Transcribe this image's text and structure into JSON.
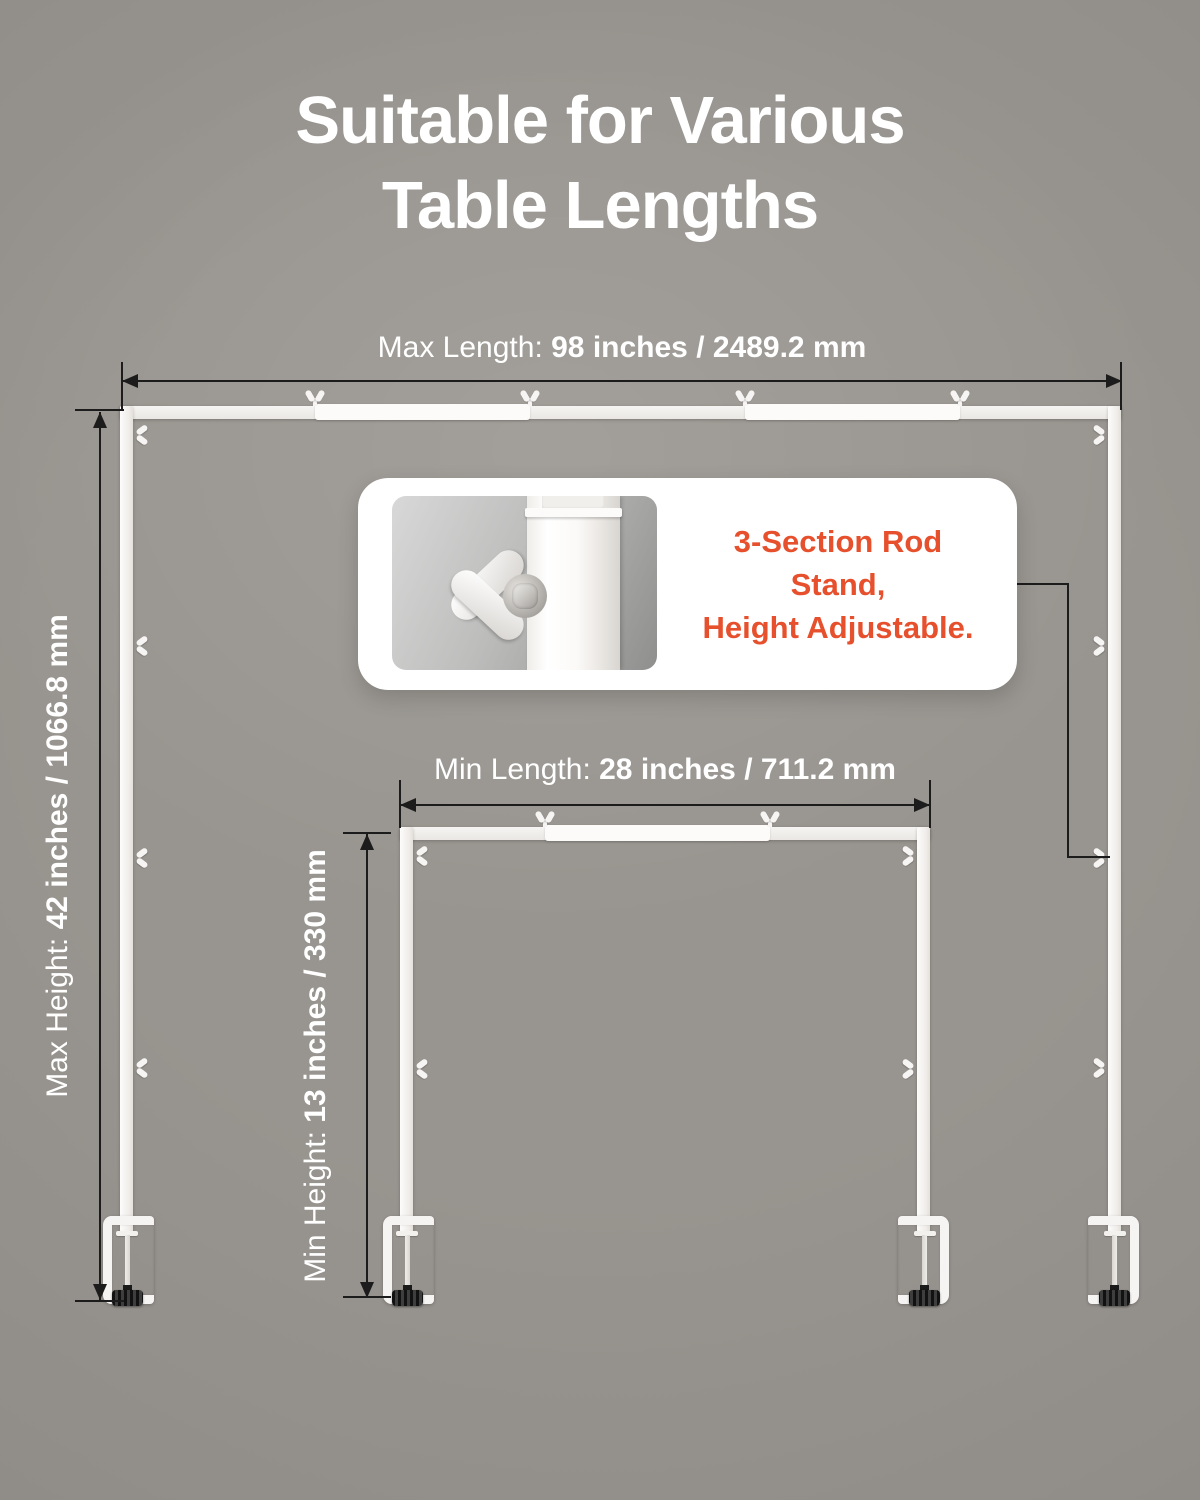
{
  "title": {
    "line1": "Suitable for Various",
    "line2": "Table Lengths"
  },
  "dimensions": {
    "max_length": {
      "label": "Max Length: ",
      "value": "98 inches / 2489.2 mm"
    },
    "max_height": {
      "label": "Max Height: ",
      "value": "42 inches / 1066.8 mm"
    },
    "min_length": {
      "label": "Min Length: ",
      "value": "28 inches / 711.2 mm"
    },
    "min_height": {
      "label": "Min Height: ",
      "value": "13 inches / 330 mm"
    }
  },
  "callout": {
    "line1": "3-Section Rod Stand,",
    "line2": "Height Adjustable."
  },
  "icons": {
    "wing_nut_clip": "wing-nut-clip-icon",
    "table_clamp": "table-clamp-icon",
    "wing_nut_photo": "wing-nut-closeup-photo"
  },
  "colors": {
    "background": "#98948F",
    "accent_orange": "#E7502D",
    "title_white": "#FFFFFF",
    "rod_white": "#F7F5F3",
    "dim_line": "#1C1C1C",
    "knob_black": "#1A1A1A"
  }
}
